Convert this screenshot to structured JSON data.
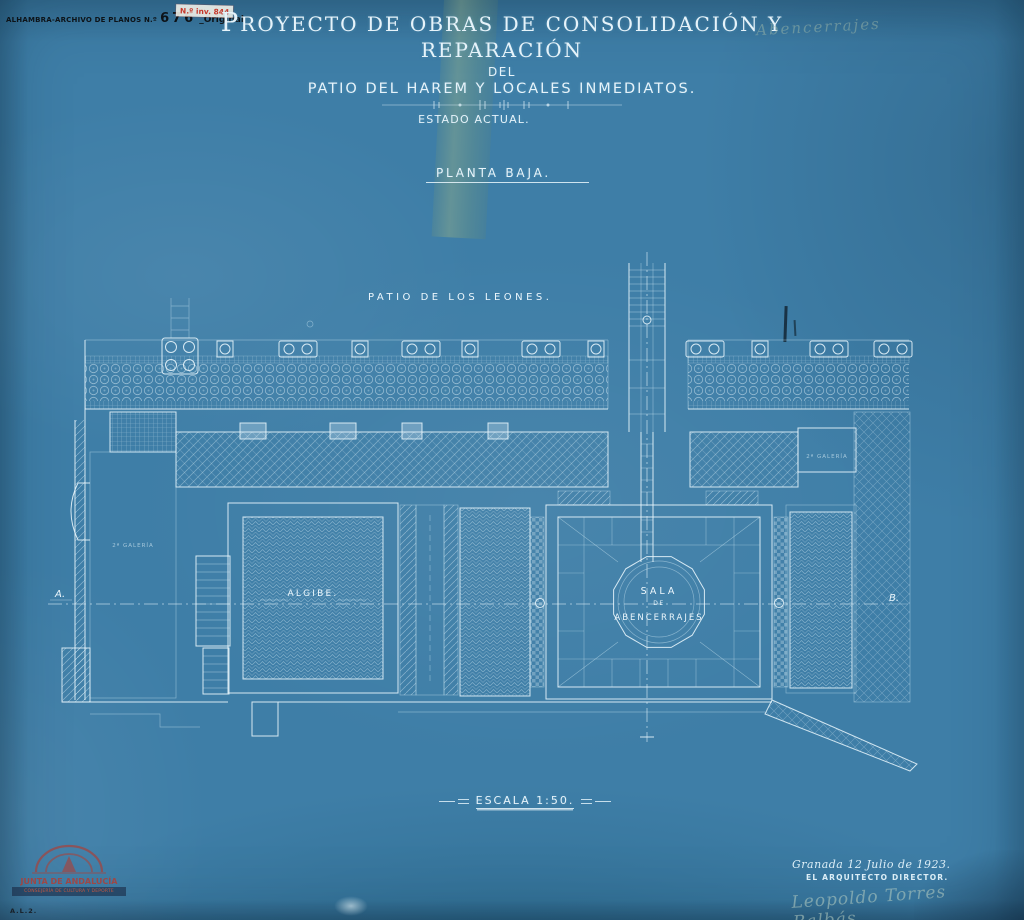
{
  "colors": {
    "paper": "#3e7ea7",
    "line": "#eaf7fd",
    "ink": "#0d1318",
    "stamp_red": "#c5392c",
    "tape_green": "#a0b47a",
    "pencil": "#9bb4a2"
  },
  "archive": {
    "label": "ALHAMBRA-ARCHIVO DE PLANOS N.º",
    "number": "676",
    "suffix": "_Original",
    "inventory": "N.º inv. 844"
  },
  "title": {
    "line1": "PROYECTO DE OBRAS DE CONSOLIDACIÓN Y REPARACIÓN",
    "line2": "DEL",
    "line3": "PATIO DEL HAREM Y LOCALES INMEDIATOS.",
    "line4": "ESTADO ACTUAL."
  },
  "notes": {
    "pencil_top_right": "Abencerrajes",
    "plan_type": "PLANTA BAJA.",
    "scale": "ESCALA 1:50."
  },
  "plan": {
    "patio": "PATIO DE LOS LEONES.",
    "algibe": "ALGIBE.",
    "sala1": "SALA",
    "sala2": "DE",
    "sala3": "ABENCERRAJES",
    "section_a": "A.",
    "section_b": "B.",
    "gallery_left": "2ª GALERÍA",
    "gallery_right": "2ª GALERÍA"
  },
  "signature": {
    "place_date": "Granada 12 Julio de 1923.",
    "role": "EL ARQUITECTO DIRECTOR.",
    "signed": "Leopoldo Torres Balbás"
  },
  "stamps": {
    "org": "JUNTA DE ANDALUCÍA",
    "dept": "CONSEJERÍA DE CULTURA Y DEPORTE",
    "code": "A.L.2."
  }
}
